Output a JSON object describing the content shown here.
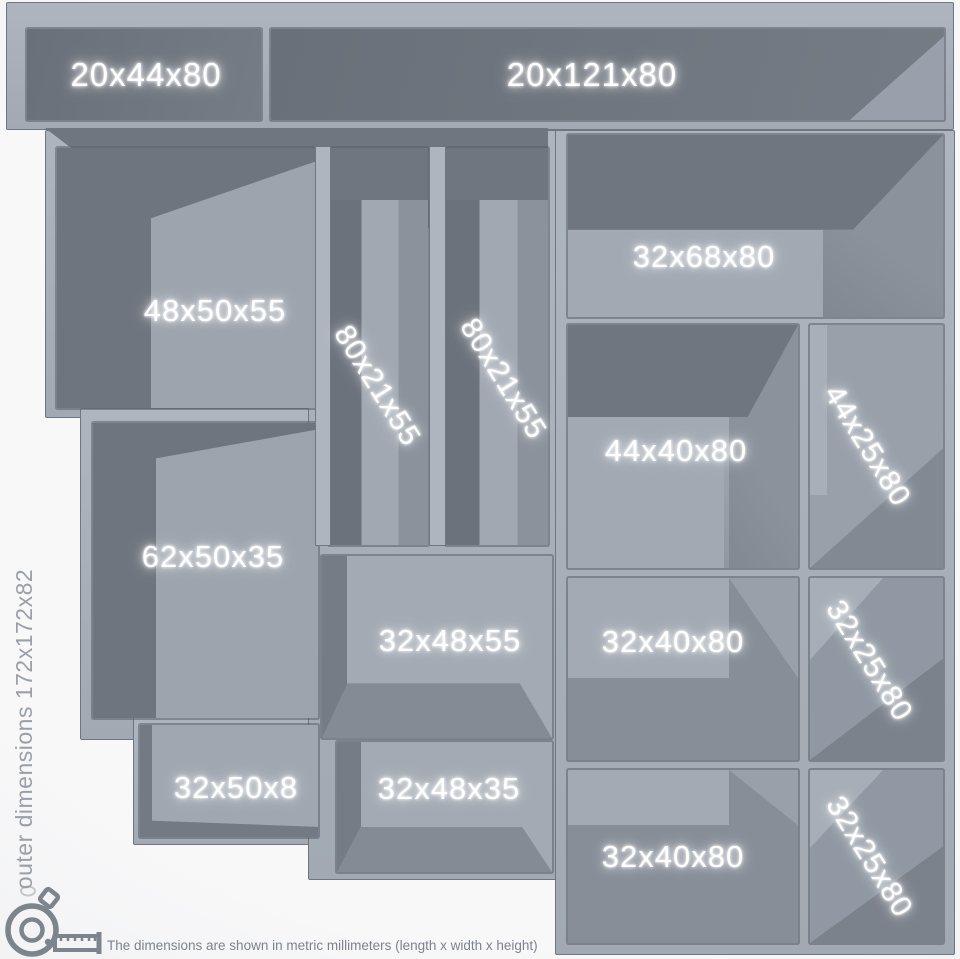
{
  "figure": {
    "side_note": "outer dimensions 172x172x82",
    "caption": "The dimensions are shown in metric millimeters (length x width x height)",
    "caption_icon": "tape-measure-icon",
    "colors": {
      "background": "#f6f6f7",
      "frame": "#a8afb9",
      "frame_outline": "#6f7681",
      "interior_dark": "#70767f",
      "interior_mid": "#8c939d",
      "interior_light": "#a2a9b3",
      "label": "#ffffff",
      "side_note": "#9aa0a8",
      "caption": "#7d838c",
      "icon": "#7d848c"
    },
    "compartments": [
      {
        "label": "20x44x80",
        "text_orientation": "horizontal"
      },
      {
        "label": "20x121x80",
        "text_orientation": "horizontal"
      },
      {
        "label": "48x50x55",
        "text_orientation": "horizontal"
      },
      {
        "label": "80x21x55",
        "text_orientation": "diagonal"
      },
      {
        "label": "80x21x55",
        "text_orientation": "diagonal"
      },
      {
        "label": "32x68x80",
        "text_orientation": "horizontal"
      },
      {
        "label": "44x40x80",
        "text_orientation": "horizontal"
      },
      {
        "label": "44x25x80",
        "text_orientation": "diagonal"
      },
      {
        "label": "62x50x35",
        "text_orientation": "horizontal"
      },
      {
        "label": "32x48x55",
        "text_orientation": "horizontal"
      },
      {
        "label": "32x40x80",
        "text_orientation": "horizontal"
      },
      {
        "label": "32x25x80",
        "text_orientation": "diagonal"
      },
      {
        "label": "32x50x8",
        "text_orientation": "horizontal"
      },
      {
        "label": "32x48x35",
        "text_orientation": "horizontal"
      },
      {
        "label": "32x40x80",
        "text_orientation": "horizontal"
      },
      {
        "label": "32x25x80",
        "text_orientation": "diagonal"
      }
    ]
  }
}
